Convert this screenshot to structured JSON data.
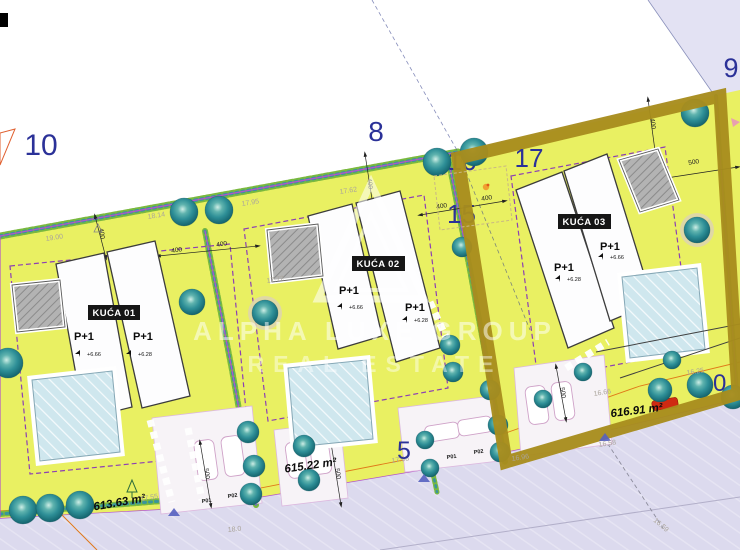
{
  "watermark": {
    "line1": "ALPHA LUXE GROUP",
    "line2": "REAL ESTATE"
  },
  "parcels": {
    "left": "10",
    "top_mid": "8",
    "top_right": "9",
    "mid_16": "16",
    "mid_15": "15",
    "plot3": "17",
    "road_5": "5",
    "road_6": "6",
    "right_10": "10"
  },
  "houses": [
    {
      "name": "KUĆA 01",
      "unit1_label": "P+1",
      "unit1_elev": "+6.66",
      "unit2_label": "P+1",
      "unit2_elev": "+6.28",
      "area": "613.63 m²"
    },
    {
      "name": "KUĆA 02",
      "unit1_label": "P+1",
      "unit1_elev": "+6.66",
      "unit2_label": "P+1",
      "unit2_elev": "+6.28",
      "area": "615.22 m²"
    },
    {
      "name": "KUĆA 03",
      "unit1_label": "P+1",
      "unit1_elev": "+6.66",
      "unit2_label": "P+1",
      "unit2_elev": "+6.28",
      "area": "616.91 m²"
    }
  ],
  "parking": {
    "plot1_p01": "P01",
    "plot1_p02": "P02",
    "plot2_p01": "P01",
    "plot2_p02": "P02"
  },
  "dimensions": {
    "v400": "400",
    "v500": "500"
  },
  "spot_heights": {
    "s19_00": "19.00",
    "s18_14": "18.14",
    "s17_95": "17.95",
    "s17_62": "17.62",
    "s17_72": "17.72",
    "s17_55": "17.55",
    "s17_08": "17.08",
    "s16_96": "16.96",
    "s16_66": "16.66",
    "s16_25": "16.25",
    "s16_58": "16.58",
    "s16_59": "16.59",
    "s18_0": "18.0"
  },
  "colors": {
    "plot_green": "#e9f062",
    "road_lavender": "#dcdaee",
    "parcel_lavender": "#e3e2f3",
    "boundary_purple": "#b455c8",
    "envelope_purple": "#8c3fb4",
    "highlight_olive": "#a88c1d",
    "parcel_number_blue": "#2b3198",
    "tree_teal": "#2e8f97",
    "pool_blue": "#cfe7ee",
    "utility_orange": "#e07818",
    "car_red": "#cf2a12"
  }
}
